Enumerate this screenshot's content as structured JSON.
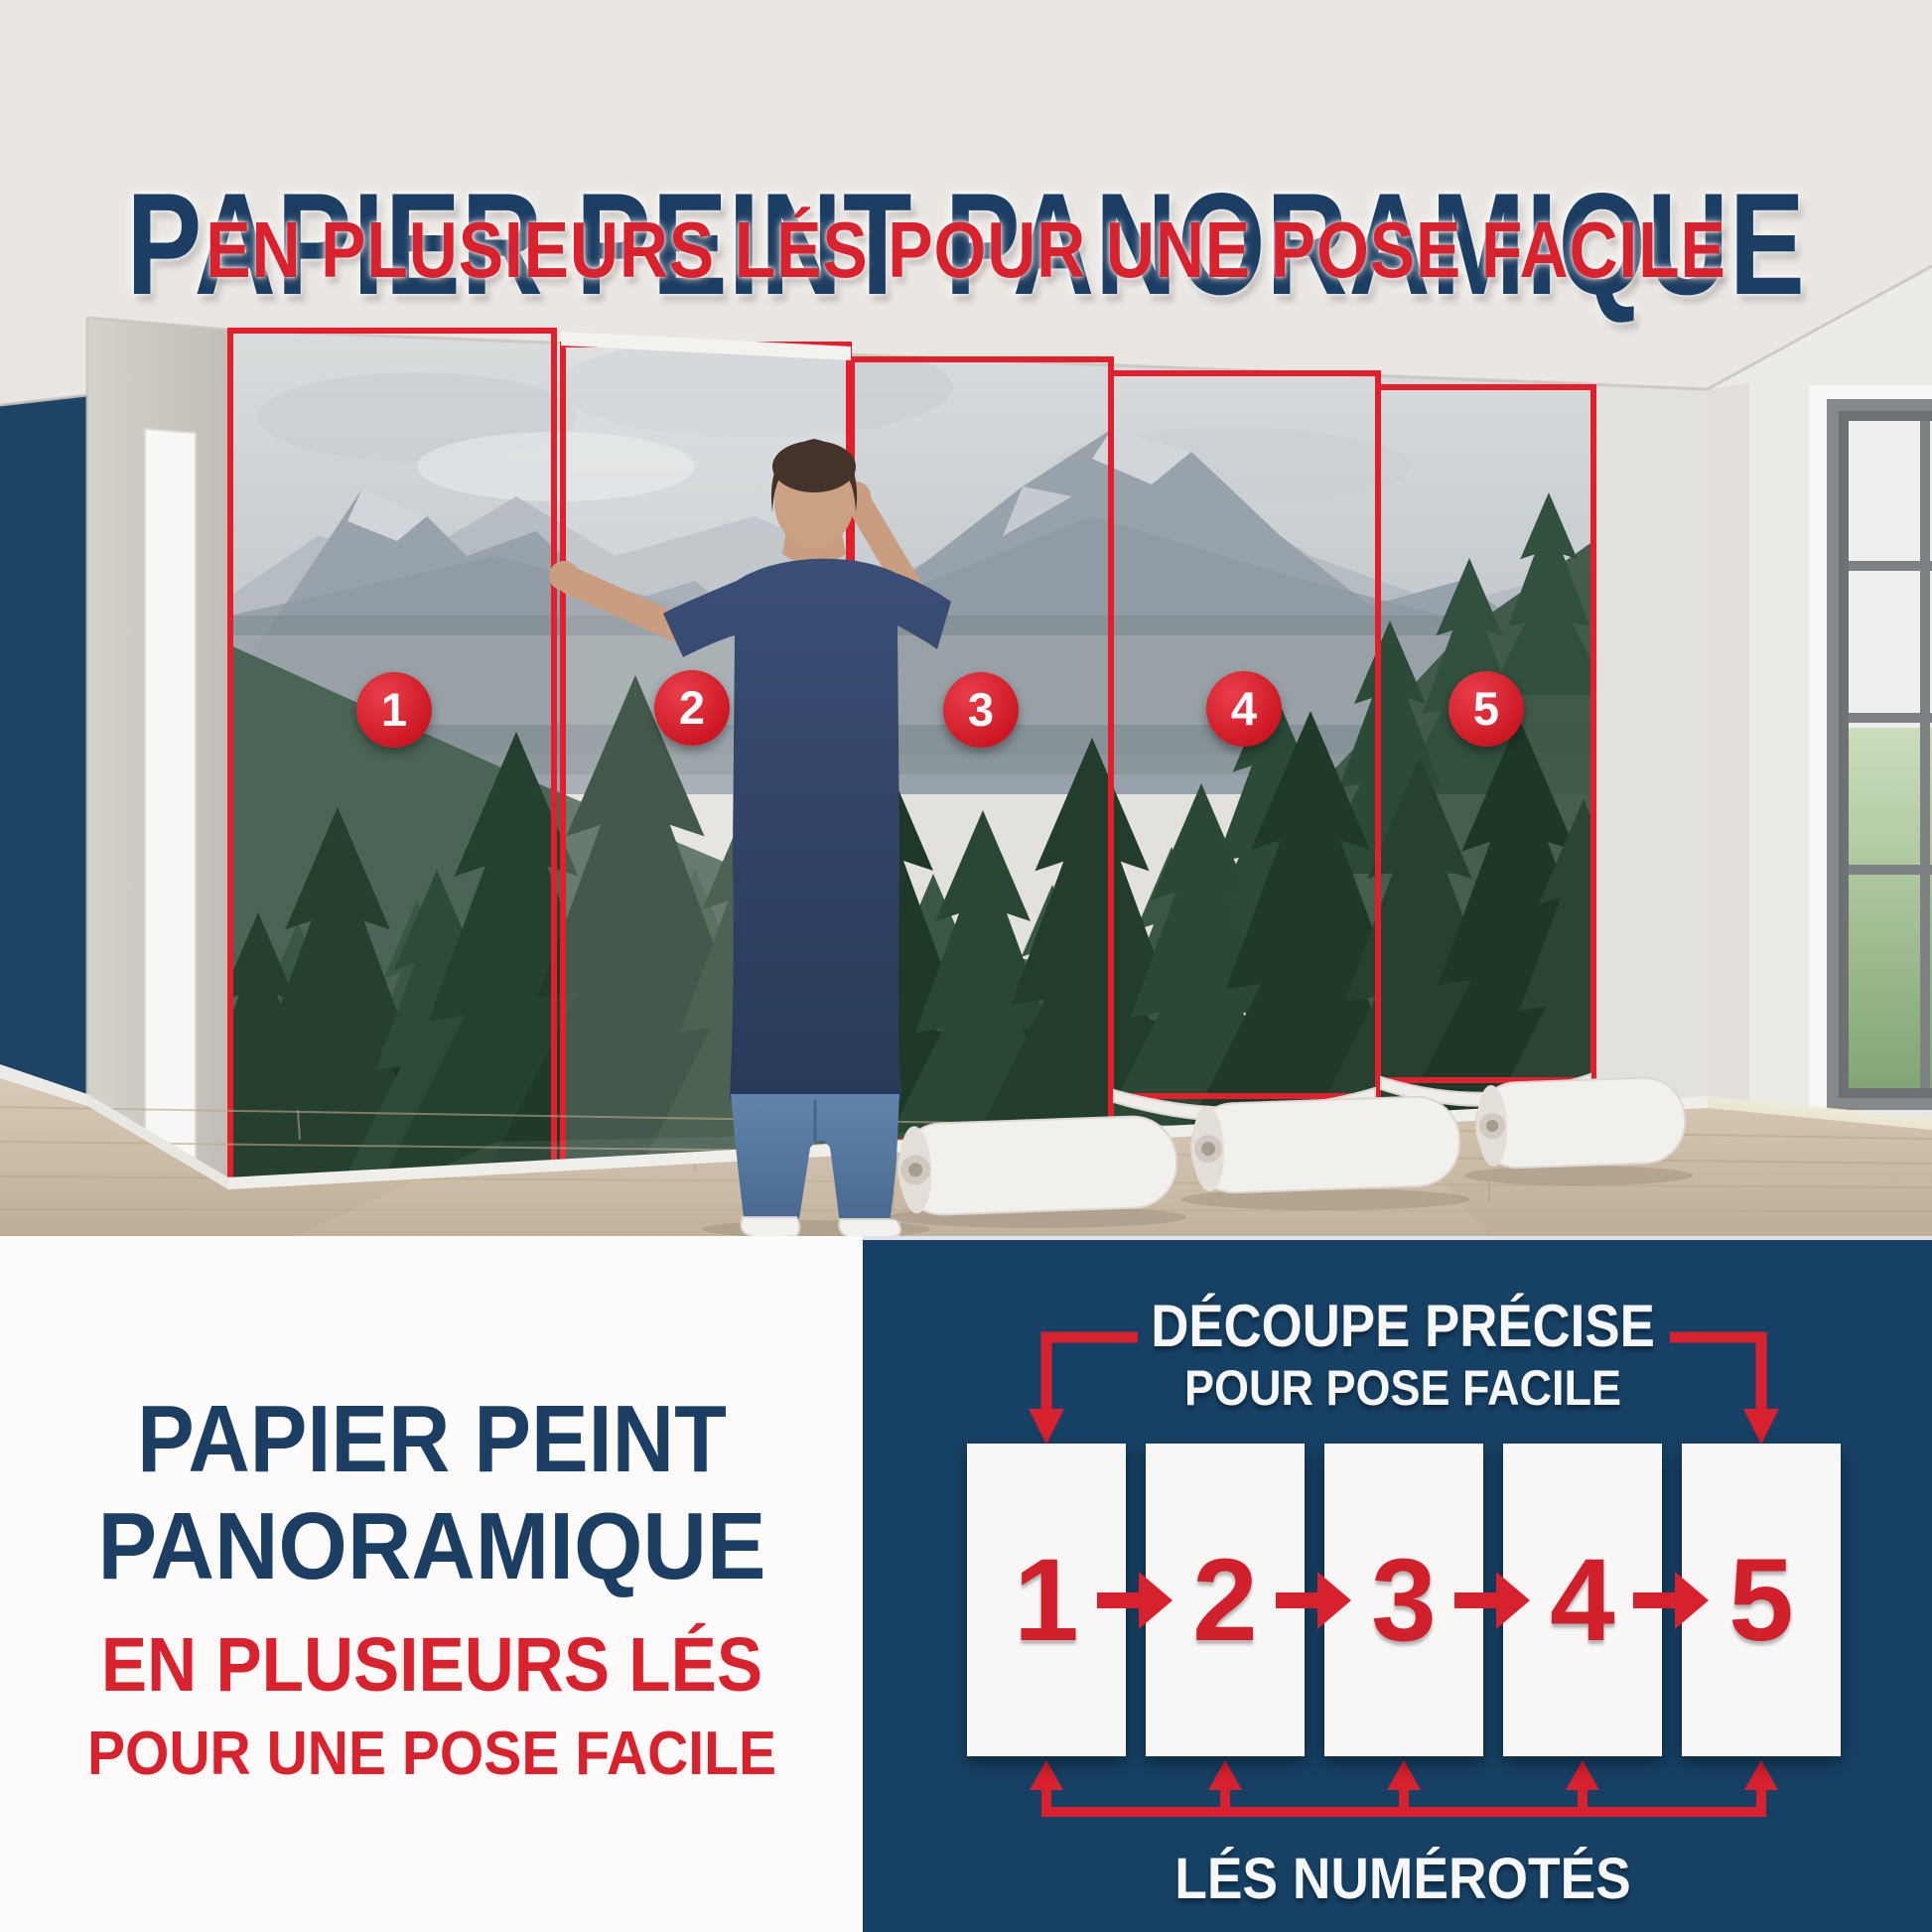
{
  "header": {
    "title": "PAPIER PEINT PANORAMIQUE",
    "subtitle": "EN PLUSIEURS LÉS POUR UNE POSE FACILE"
  },
  "photo": {
    "strip_numbers": [
      "1",
      "2",
      "3",
      "4",
      "5"
    ]
  },
  "bottom_left": {
    "title_line1": "PAPIER PEINT",
    "title_line2": "PANORAMIQUE",
    "subtitle_line1": "EN PLUSIEURS LÉS",
    "subtitle_line2": "POUR UNE POSE FACILE"
  },
  "diagram": {
    "heading_line1": "DÉCOUPE PRÉCISE",
    "heading_line2": "POUR POSE FACILE",
    "strip_numbers": [
      "1",
      "2",
      "3",
      "4",
      "5"
    ],
    "caption": "LÉS NUMÉROTÉS"
  },
  "colors": {
    "navy_text": "#1c3e63",
    "red_accent": "#d8232f",
    "circle_red": "#d6202c",
    "diagram_bg": "#164165",
    "panel_white": "#f8f7f5"
  }
}
